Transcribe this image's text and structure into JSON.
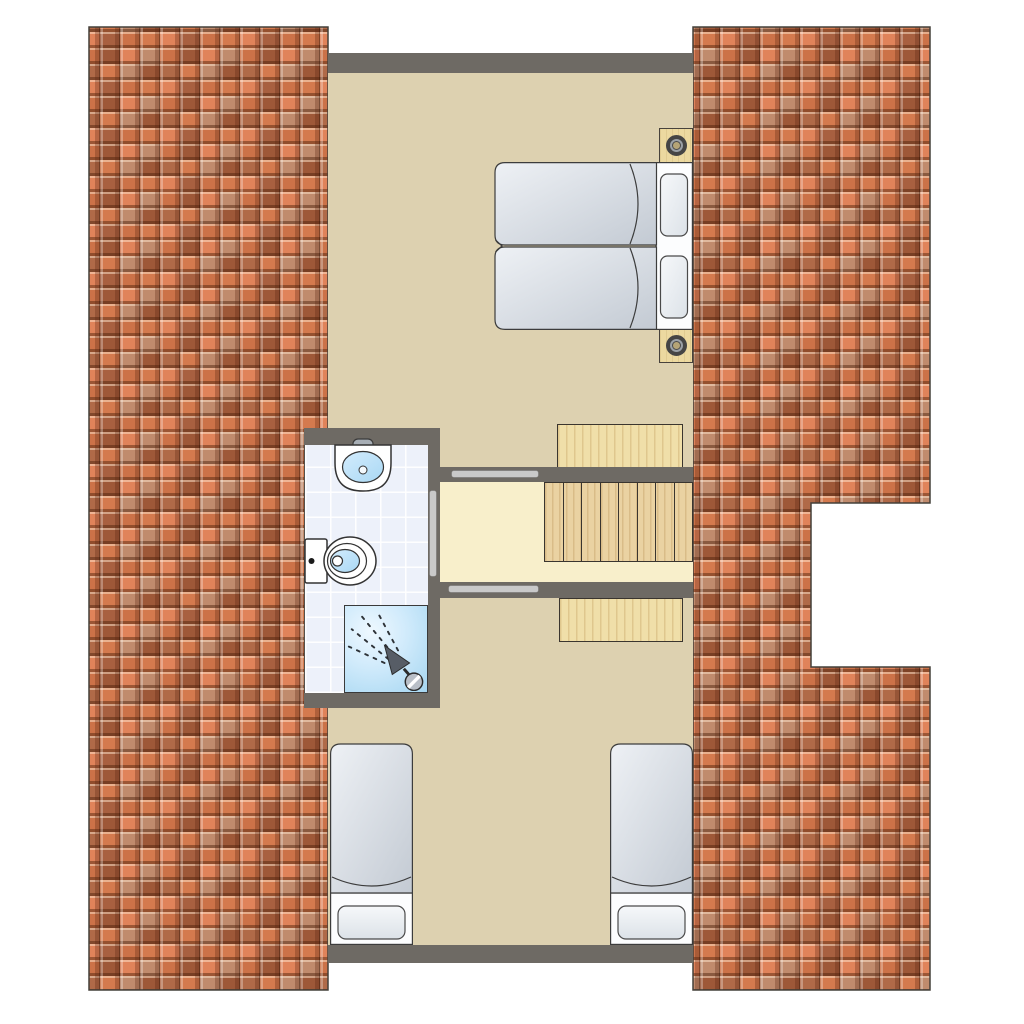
{
  "title": "Attic floor plan — two bedrooms, bathroom and staircase between pitched roof sections",
  "colors": {
    "roof_tile_base": "#cc7248",
    "roof_tile_dark": "#9e5838",
    "roof_tile_bright": "#e0835a",
    "roof_tile_salmon": "#c08b6d",
    "wall": "#6e6a64",
    "bedroom_floor": "#ddd1b0",
    "landing_floor": "#f8efcb",
    "stair_wood": "#ead2a2",
    "platform_wood": "#f0dfa9",
    "bathroom_tile": "#edf1fa",
    "shower_blue": "#a5d6f1",
    "bed_linen": "#dfe5eb",
    "door_leaf": "#c9c9c9"
  },
  "roof": {
    "left_section": "full-height tiled roof strip",
    "right_section": "tiled roof strip with rectangular notch at stair void",
    "tile_style": "interlocking S-tiles, mixed orange/brown/salmon"
  },
  "rooms": {
    "bedroom_top": {
      "label": "Top bedroom",
      "beds": 2,
      "bed_arrangement": "two single mattresses pushed together, heads to the right wall",
      "nightstands": 2,
      "lamps": 2
    },
    "bathroom": {
      "label": "Bathroom",
      "fixtures": [
        "washbasin with faucet",
        "toilet with cistern",
        "shower with spray head"
      ]
    },
    "landing": {
      "label": "Stair landing",
      "staircase_treads": 8,
      "stair_platforms": 2,
      "door_openings": [
        "to top bedroom",
        "to bottom bedroom",
        "to bathroom"
      ]
    },
    "bedroom_bottom": {
      "label": "Bottom bedroom",
      "beds": 2,
      "bed_arrangement": "two separate single beds, heads to the bottom wall"
    }
  }
}
